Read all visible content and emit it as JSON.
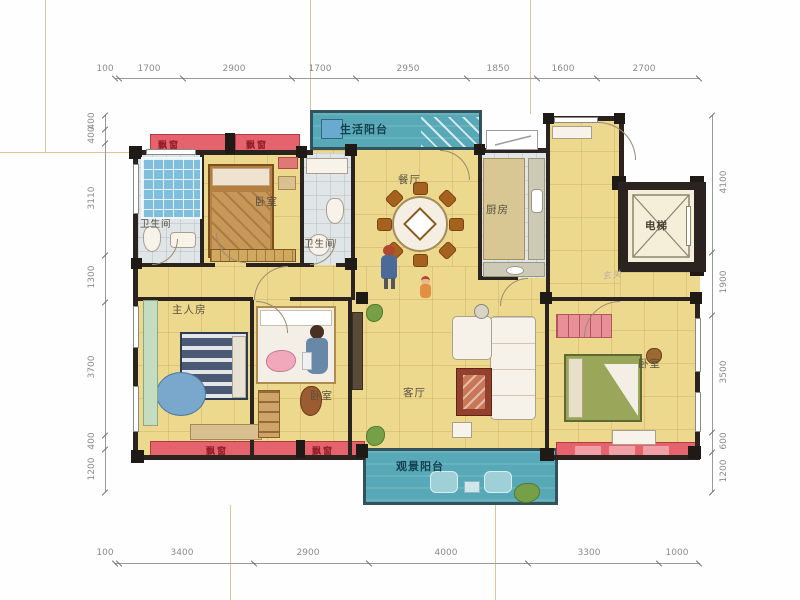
{
  "rooms": {
    "service_balcony": "生活阳台",
    "dining": "餐厅",
    "kitchen": "厨房",
    "elevator": "电梯",
    "bedroom_a": "卧室",
    "bath_a": "卫生间",
    "bath_b": "卫生间",
    "master": "主人房",
    "bedroom_b": "卧室",
    "living": "客厅",
    "bedroom_c": "卧室",
    "view_balcony": "观景阳台",
    "foyer": "玄关"
  },
  "bays": {
    "top_left": "飘窗",
    "top_mid": "飘窗",
    "bottom_left": "飘窗",
    "bottom_mid": "飘窗"
  },
  "dims": {
    "top": [
      "100",
      "1700",
      "2900",
      "1700",
      "2950",
      "1850",
      "1600",
      "2700"
    ],
    "bottom": [
      "100",
      "3400",
      "2900",
      "4000",
      "3300",
      "1000"
    ],
    "left": [
      "400",
      "400",
      "3110",
      "1300",
      "3700",
      "400",
      "1200"
    ],
    "right": [
      "4100",
      "1900",
      "3500",
      "600",
      "1200"
    ]
  },
  "colors": {
    "wall": "#2a231f",
    "floor": "#edd98e",
    "balcony": "#57a9b7",
    "bay_window": "#e5636c"
  }
}
